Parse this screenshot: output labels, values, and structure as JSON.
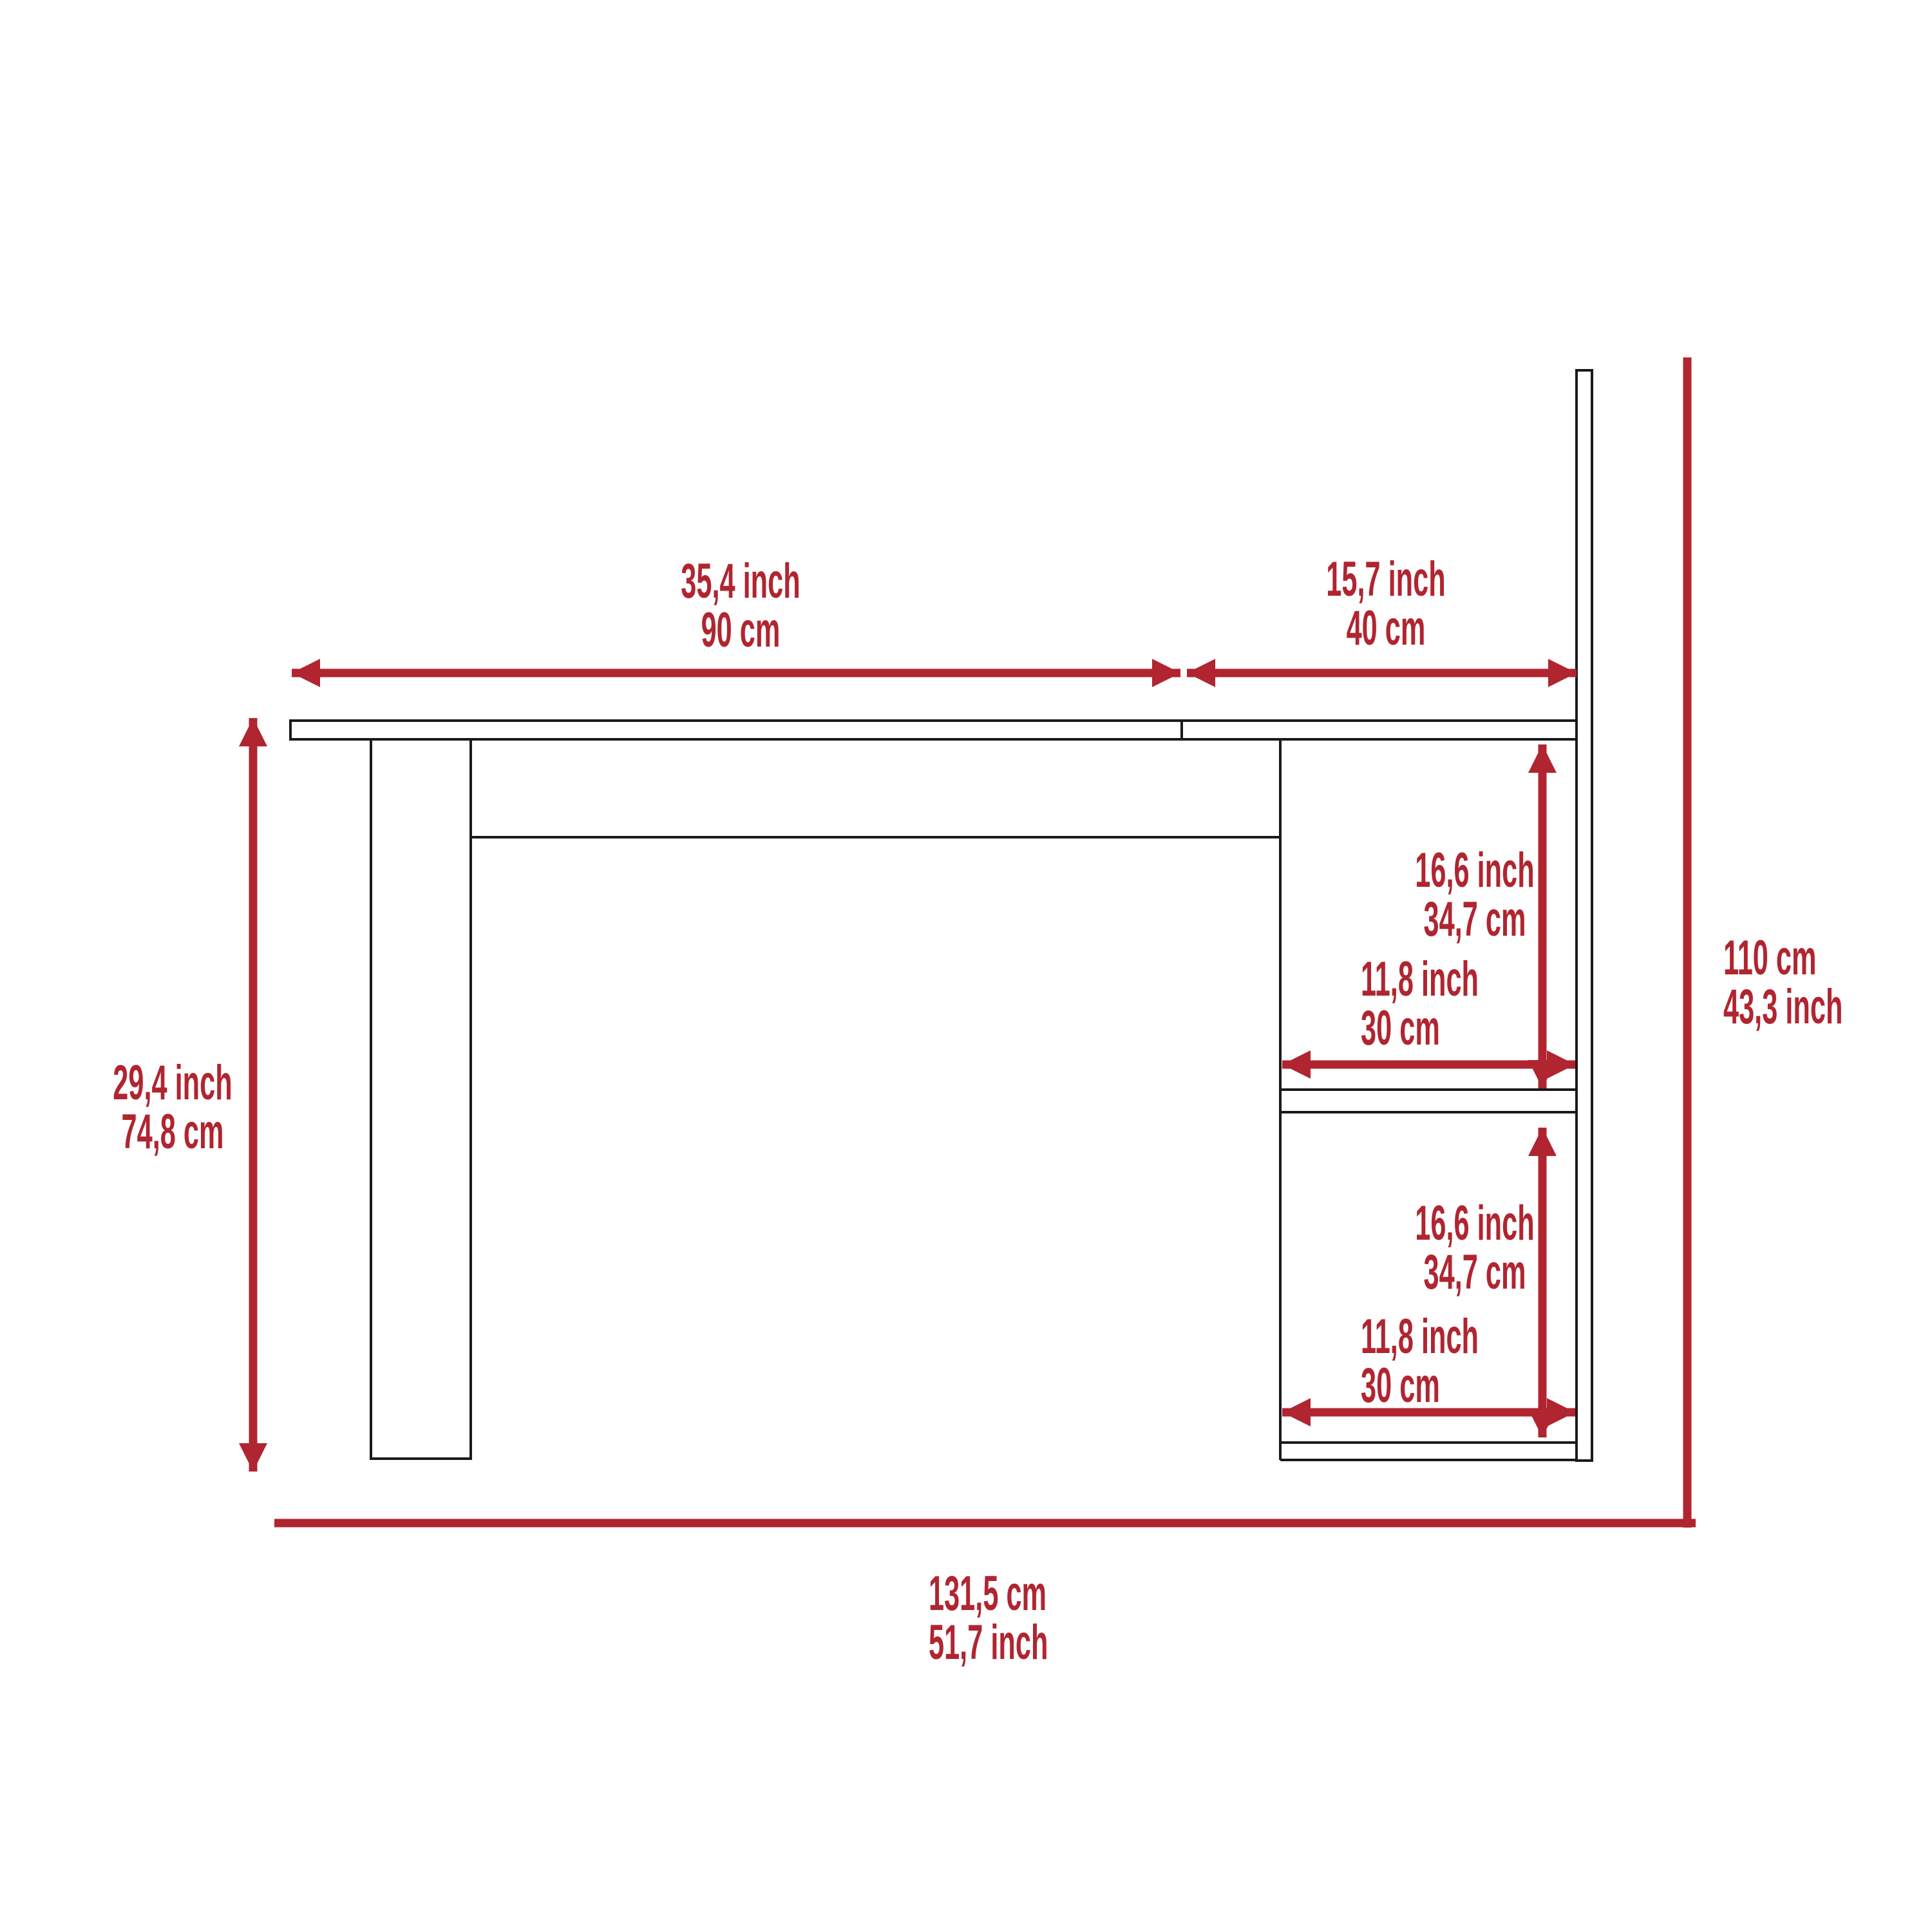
{
  "diagram_title": "desk-dimension-diagram",
  "colors": {
    "accent": "#B02530",
    "line": "#1A1A1A",
    "background": "#FFFFFF"
  },
  "labels": {
    "top_width_main": {
      "line1": "35,4 inch",
      "line2": "90 cm"
    },
    "top_width_return": {
      "line1": "15,7 inch",
      "line2": "40 cm"
    },
    "height_desk": {
      "line1": "29,4 inch",
      "line2": "74,8 cm"
    },
    "height_total": {
      "line1": "110 cm",
      "line2": "43,3 inch"
    },
    "width_total": {
      "line1": "131,5 cm",
      "line2": "51,7 inch"
    },
    "shelf_top_height": {
      "line1": "16,6 inch",
      "line2": "34,7 cm"
    },
    "shelf_top_width": {
      "line1": "11,8 inch",
      "line2": "30 cm"
    },
    "shelf_bottom_height": {
      "line1": "16,6 inch",
      "line2": "34,7 cm"
    },
    "shelf_bottom_width": {
      "line1": "11,8 inch",
      "line2": "30 cm"
    }
  }
}
